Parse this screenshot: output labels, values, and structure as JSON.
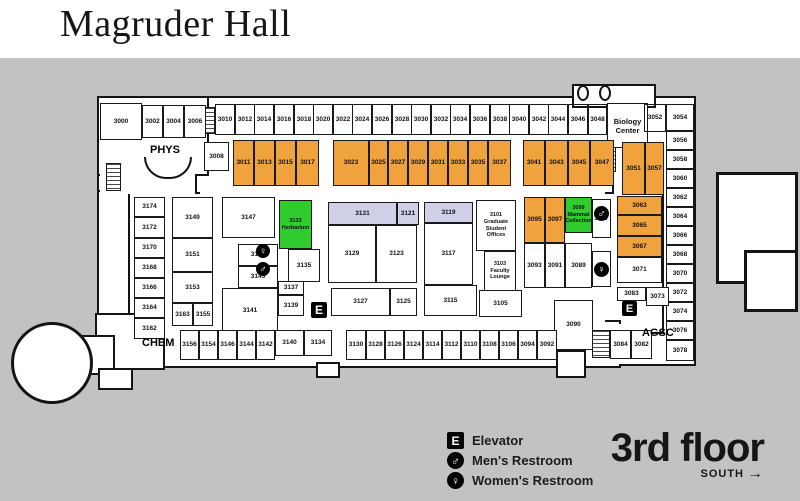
{
  "title": "Magruder Hall",
  "floor": {
    "name": "3rd floor",
    "direction": "SOUTH",
    "arrow": "→"
  },
  "legend": {
    "items": [
      {
        "type": "elev",
        "glyph": "E",
        "label": "Elevator"
      },
      {
        "type": "mens",
        "glyph": "♂",
        "label": "Men's Restroom"
      },
      {
        "type": "womens",
        "glyph": "♀",
        "label": "Women's Restroom"
      }
    ]
  },
  "colors": {
    "yellow": "#ffe115",
    "orange": "#f0a23c",
    "green": "#2fcb2f",
    "lavender": "#cfcfe8",
    "white": "#ffffff",
    "background": "#c2c2c2",
    "wall": "#141414"
  },
  "area_labels": [
    {
      "id": "phys",
      "text": "PHYS",
      "x": 150,
      "y": 144,
      "fs": 11
    },
    {
      "id": "chem",
      "text": "CHEM",
      "x": 142,
      "y": 337,
      "fs": 11
    },
    {
      "id": "agsc",
      "text": "AGSC",
      "x": 642,
      "y": 327,
      "fs": 11
    }
  ],
  "footprint": [
    {
      "x": 190,
      "y": 96,
      "w": 430,
      "h": 100
    },
    {
      "x": 612,
      "y": 96,
      "w": 84,
      "h": 270
    },
    {
      "x": 97,
      "y": 96,
      "w": 100,
      "h": 100
    },
    {
      "x": 97,
      "y": 96,
      "w": 112,
      "h": 80
    },
    {
      "x": 97,
      "y": 190,
      "w": 40,
      "h": 165
    },
    {
      "x": 128,
      "y": 192,
      "w": 536,
      "h": 142
    },
    {
      "x": 143,
      "y": 320,
      "w": 478,
      "h": 48
    },
    {
      "x": 95,
      "y": 313,
      "w": 70,
      "h": 57
    },
    {
      "x": 572,
      "y": 84,
      "w": 84,
      "h": 24
    },
    {
      "x": 75,
      "y": 335,
      "w": 40,
      "h": 40
    },
    {
      "x": 98,
      "y": 368,
      "w": 35,
      "h": 22
    },
    {
      "x": 316,
      "y": 362,
      "w": 24,
      "h": 16
    },
    {
      "x": 556,
      "y": 350,
      "w": 30,
      "h": 28
    },
    {
      "type": "circle",
      "x": 11,
      "y": 322,
      "w": 82,
      "h": 82
    },
    {
      "type": "thick",
      "x": 716,
      "y": 172,
      "w": 82,
      "h": 112
    },
    {
      "type": "thick",
      "x": 744,
      "y": 250,
      "w": 54,
      "h": 62
    }
  ],
  "patches": [
    {
      "x": 200,
      "y": 188,
      "w": 405,
      "h": 12
    },
    {
      "x": 150,
      "y": 314,
      "w": 455,
      "h": 20
    },
    {
      "x": 614,
      "y": 189,
      "w": 46,
      "h": 10
    },
    {
      "x": 608,
      "y": 324,
      "w": 14,
      "h": 40
    },
    {
      "x": 100,
      "y": 168,
      "w": 95,
      "h": 26
    }
  ],
  "stairs": [
    {
      "x": 202,
      "y": 107,
      "w": 13,
      "h": 27
    },
    {
      "x": 106,
      "y": 163,
      "w": 15,
      "h": 28
    },
    {
      "x": 604,
      "y": 146,
      "w": 12,
      "h": 26
    },
    {
      "x": 592,
      "y": 330,
      "w": 18,
      "h": 28
    }
  ],
  "columns": [
    {
      "x": 577,
      "y": 85,
      "w": 12,
      "h": 16
    },
    {
      "x": 599,
      "y": 85,
      "w": 12,
      "h": 16
    }
  ],
  "arc": {
    "x": 144,
    "y": 157,
    "w": 48,
    "h": 22
  },
  "icons": [
    {
      "type": "womens",
      "glyph": "♀",
      "x": 256,
      "y": 244,
      "s": 14
    },
    {
      "type": "mens",
      "glyph": "♂",
      "x": 256,
      "y": 262,
      "s": 14
    },
    {
      "type": "mens",
      "glyph": "♂",
      "x": 594,
      "y": 206,
      "s": 15
    },
    {
      "type": "womens",
      "glyph": "♀",
      "x": 594,
      "y": 262,
      "s": 15
    },
    {
      "type": "elev",
      "glyph": "E",
      "x": 311,
      "y": 302,
      "s": 16
    },
    {
      "type": "elev",
      "glyph": "E",
      "x": 622,
      "y": 301,
      "s": 15
    }
  ],
  "rooms": [
    [
      "3010",
      215,
      104,
      20,
      31,
      "y"
    ],
    [
      "3012",
      235,
      104,
      20,
      31,
      "y"
    ],
    [
      "3014",
      254,
      104,
      20,
      31,
      "y"
    ],
    [
      "3016",
      274,
      104,
      20,
      31,
      "y"
    ],
    [
      "3018",
      294,
      104,
      20,
      31,
      "y"
    ],
    [
      "3020",
      313,
      104,
      20,
      31,
      "y"
    ],
    [
      "3022",
      333,
      104,
      20,
      31,
      "y"
    ],
    [
      "3024",
      352,
      104,
      20,
      31,
      "y"
    ],
    [
      "3026",
      372,
      104,
      20,
      31,
      "y"
    ],
    [
      "3028",
      392,
      104,
      20,
      31,
      "y"
    ],
    [
      "3030",
      411,
      104,
      20,
      31,
      "y"
    ],
    [
      "3032",
      431,
      104,
      20,
      31,
      "y"
    ],
    [
      "3034",
      450,
      104,
      20,
      31,
      "y"
    ],
    [
      "3036",
      470,
      104,
      20,
      31,
      "y"
    ],
    [
      "3038",
      490,
      104,
      20,
      31,
      "y"
    ],
    [
      "3040",
      509,
      104,
      20,
      31,
      "y"
    ],
    [
      "3042",
      529,
      104,
      20,
      31,
      "y"
    ],
    [
      "3044",
      548,
      104,
      20,
      31,
      "y"
    ],
    [
      "3046",
      568,
      104,
      20,
      31,
      "y"
    ],
    [
      "3048",
      588,
      104,
      19,
      31,
      "y"
    ],
    [
      "biology-center",
      607,
      103,
      41,
      45,
      "w",
      [
        "Biology",
        "Center"
      ]
    ],
    [
      "3052",
      644,
      104,
      22,
      28,
      "y"
    ],
    [
      "3054",
      666,
      104,
      28,
      27,
      "y"
    ],
    [
      "3056",
      666,
      131,
      28,
      19,
      "y"
    ],
    [
      "3058",
      666,
      150,
      28,
      19,
      "y"
    ],
    [
      "3060",
      666,
      169,
      28,
      19,
      "y"
    ],
    [
      "3062",
      666,
      188,
      28,
      19,
      "y"
    ],
    [
      "3064",
      666,
      207,
      28,
      19,
      "y"
    ],
    [
      "3066",
      666,
      226,
      28,
      19,
      "y"
    ],
    [
      "3068",
      666,
      245,
      28,
      19,
      "y"
    ],
    [
      "3070",
      666,
      264,
      28,
      19,
      "y"
    ],
    [
      "3072",
      666,
      283,
      28,
      19,
      "w"
    ],
    [
      "3074",
      666,
      302,
      28,
      19,
      "w"
    ],
    [
      "3076",
      666,
      321,
      28,
      19,
      "w"
    ],
    [
      "3078",
      666,
      340,
      28,
      21,
      "w"
    ],
    [
      "3011",
      233,
      140,
      21,
      46,
      "o"
    ],
    [
      "3013",
      254,
      140,
      21,
      46,
      "o"
    ],
    [
      "3015",
      275,
      140,
      21,
      46,
      "o"
    ],
    [
      "3017",
      296,
      140,
      23,
      46,
      "o"
    ],
    [
      "3023",
      333,
      140,
      36,
      46,
      "o"
    ],
    [
      "3025",
      369,
      140,
      19,
      46,
      "o"
    ],
    [
      "3027",
      388,
      140,
      20,
      46,
      "o"
    ],
    [
      "3029",
      408,
      140,
      20,
      46,
      "o"
    ],
    [
      "3031",
      428,
      140,
      20,
      46,
      "o"
    ],
    [
      "3033",
      448,
      140,
      20,
      46,
      "o"
    ],
    [
      "3035",
      468,
      140,
      20,
      46,
      "o"
    ],
    [
      "3037",
      488,
      140,
      23,
      46,
      "o"
    ],
    [
      "3041",
      523,
      140,
      22,
      46,
      "o"
    ],
    [
      "3043",
      545,
      140,
      23,
      46,
      "o"
    ],
    [
      "3045",
      568,
      140,
      22,
      46,
      "o"
    ],
    [
      "3047",
      590,
      140,
      24,
      46,
      "o"
    ],
    [
      "3051",
      622,
      142,
      23,
      53,
      "o"
    ],
    [
      "3057",
      645,
      142,
      19,
      53,
      "o"
    ],
    [
      "3000",
      100,
      103,
      42,
      37,
      "w"
    ],
    [
      "3002",
      142,
      105,
      21,
      33,
      "w"
    ],
    [
      "3004",
      163,
      105,
      21,
      33,
      "w"
    ],
    [
      "3006",
      184,
      105,
      22,
      33,
      "w"
    ],
    [
      "3008",
      204,
      142,
      25,
      29,
      "w"
    ],
    [
      "3174",
      134,
      197,
      31,
      20,
      "w"
    ],
    [
      "3172",
      134,
      217,
      31,
      21,
      "w"
    ],
    [
      "3170",
      134,
      238,
      31,
      20,
      "w"
    ],
    [
      "3168",
      134,
      258,
      31,
      20,
      "w"
    ],
    [
      "3166",
      134,
      278,
      31,
      20,
      "w"
    ],
    [
      "3164",
      134,
      298,
      31,
      20,
      "w"
    ],
    [
      "3162",
      134,
      318,
      31,
      21,
      "w"
    ],
    [
      "3149",
      172,
      197,
      41,
      41,
      "w"
    ],
    [
      "3151",
      172,
      238,
      41,
      34,
      "w"
    ],
    [
      "3153",
      172,
      272,
      41,
      31,
      "w"
    ],
    [
      "3163",
      172,
      303,
      21,
      23,
      "w"
    ],
    [
      "3155",
      193,
      303,
      20,
      23,
      "w"
    ],
    [
      "3147",
      222,
      197,
      53,
      41,
      "w"
    ],
    [
      "3145",
      238,
      244,
      40,
      22,
      "w"
    ],
    [
      "3143",
      238,
      266,
      40,
      22,
      "w"
    ],
    [
      "3141",
      222,
      288,
      56,
      45,
      "w"
    ],
    [
      "3137",
      278,
      281,
      26,
      14,
      "w"
    ],
    [
      "3139",
      278,
      295,
      26,
      21,
      "w"
    ],
    [
      "3133",
      279,
      200,
      33,
      49,
      "g",
      [
        "3133",
        "Herbarium"
      ]
    ],
    [
      "3135",
      288,
      249,
      32,
      33,
      "w"
    ],
    [
      "3131",
      328,
      202,
      69,
      23,
      "l"
    ],
    [
      "3121",
      397,
      202,
      22,
      23,
      "l"
    ],
    [
      "3119",
      424,
      202,
      49,
      21,
      "l"
    ],
    [
      "3129",
      328,
      225,
      48,
      58,
      "w"
    ],
    [
      "3123",
      376,
      225,
      41,
      58,
      "w"
    ],
    [
      "3117",
      424,
      223,
      49,
      62,
      "w"
    ],
    [
      "3127",
      331,
      288,
      59,
      28,
      "w"
    ],
    [
      "3125",
      390,
      288,
      27,
      28,
      "w"
    ],
    [
      "3115",
      424,
      285,
      53,
      31,
      "w"
    ],
    [
      "3105",
      479,
      290,
      43,
      27,
      "w"
    ],
    [
      "3101",
      476,
      200,
      40,
      51,
      "y",
      [
        "3101",
        "Graduate Student",
        "Offices"
      ]
    ],
    [
      "3103",
      484,
      251,
      32,
      40,
      "y",
      [
        "3103",
        "Faculty",
        "Lounge"
      ]
    ],
    [
      "3095",
      524,
      197,
      21,
      46,
      "o"
    ],
    [
      "3097",
      545,
      197,
      20,
      46,
      "o"
    ],
    [
      "3099",
      565,
      197,
      27,
      36,
      "g",
      [
        "3099",
        "Mammal",
        "Collection"
      ]
    ],
    [
      "3087",
      592,
      199,
      19,
      39,
      "w"
    ],
    [
      "3093",
      524,
      243,
      21,
      45,
      "w"
    ],
    [
      "3091",
      545,
      243,
      20,
      45,
      "w"
    ],
    [
      "3089",
      565,
      243,
      27,
      45,
      "w"
    ],
    [
      "3085",
      592,
      251,
      19,
      36,
      "w"
    ],
    [
      "3063",
      617,
      196,
      45,
      19,
      "o"
    ],
    [
      "3065",
      617,
      215,
      45,
      21,
      "o"
    ],
    [
      "3067",
      617,
      236,
      45,
      21,
      "o"
    ],
    [
      "3071",
      617,
      257,
      45,
      26,
      "w"
    ],
    [
      "3083",
      617,
      287,
      29,
      14,
      "w"
    ],
    [
      "3073",
      646,
      287,
      23,
      19,
      "w"
    ],
    [
      "3090",
      554,
      300,
      39,
      50,
      "w"
    ],
    [
      "3156",
      180,
      330,
      19,
      30,
      "w"
    ],
    [
      "3154",
      199,
      330,
      19,
      30,
      "w"
    ],
    [
      "3146",
      218,
      330,
      19,
      30,
      "w"
    ],
    [
      "3144",
      237,
      330,
      19,
      30,
      "w"
    ],
    [
      "3142",
      256,
      330,
      19,
      30,
      "w"
    ],
    [
      "3140",
      275,
      330,
      29,
      26,
      "w"
    ],
    [
      "3134",
      304,
      330,
      28,
      26,
      "w"
    ],
    [
      "3130",
      346,
      330,
      20,
      30,
      "w"
    ],
    [
      "3128",
      366,
      330,
      19,
      30,
      "w"
    ],
    [
      "3126",
      385,
      330,
      19,
      30,
      "w"
    ],
    [
      "3124",
      404,
      330,
      19,
      30,
      "w"
    ],
    [
      "3114",
      423,
      330,
      19,
      30,
      "w"
    ],
    [
      "3112",
      442,
      330,
      19,
      30,
      "w"
    ],
    [
      "3110",
      461,
      330,
      19,
      30,
      "w"
    ],
    [
      "3108",
      480,
      330,
      19,
      30,
      "w"
    ],
    [
      "3106",
      499,
      330,
      19,
      30,
      "w"
    ],
    [
      "3094",
      518,
      330,
      19,
      30,
      "w"
    ],
    [
      "3092",
      537,
      330,
      20,
      30,
      "w"
    ],
    [
      "3084",
      610,
      330,
      21,
      29,
      "w"
    ],
    [
      "3082",
      631,
      330,
      21,
      29,
      "w"
    ]
  ]
}
